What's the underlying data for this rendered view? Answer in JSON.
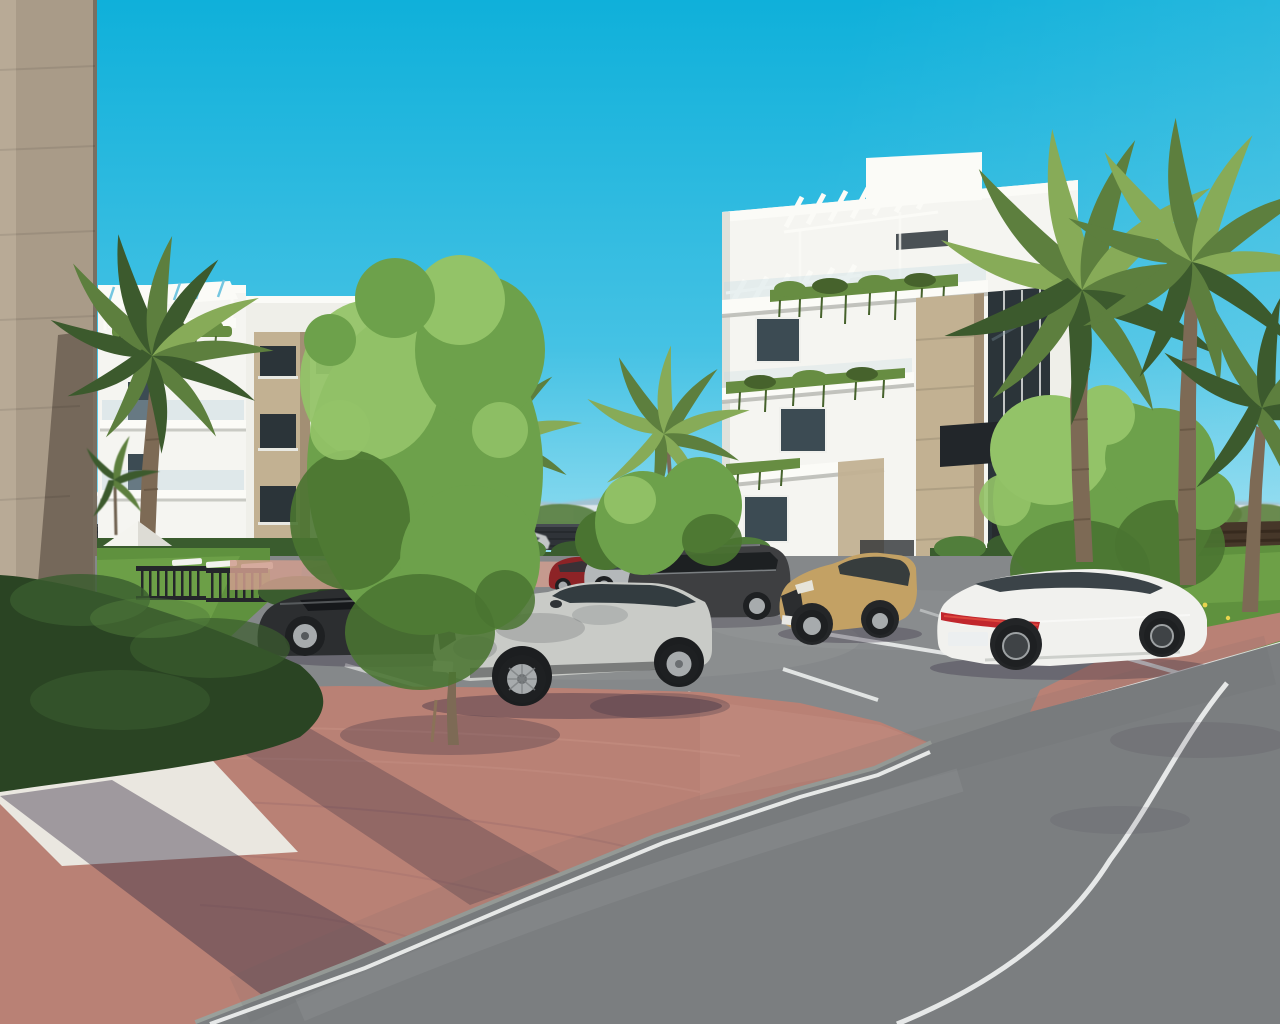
{
  "scene": {
    "title": "Exterior 3D render of a new-build apartment complex with parking",
    "description": "Photorealistic architectural rendering: two modern white apartment buildings with rooftop pergolas, planted balconies and beige stone cladding, surrounded by palm trees, deciduous trees, trimmed hedges and a lawn garden with a white parasol and sun loungers. Seven cars occupy an asphalt parking area beside a red clay-brick pedestrian walkway and a curving asphalt road under a clear cyan sky, with a marina town strip and mountains on the horizon.",
    "colors": {
      "sky_top": "#0fb0da",
      "sky_mid": "#45c2e4",
      "sky_horizon": "#9be0f2",
      "mountain": "#a9c0cd",
      "distant_building": "#dde6ea",
      "fence_dark": "#2f3338",
      "fence_brown": "#463729",
      "wall_face": "#a99b88",
      "wall_light": "#bcae9a",
      "wall_shade": "#6f6355",
      "building_white": "#f5f5f1",
      "building_tint": "#efefe9",
      "pergola_white": "#fbfbf7",
      "stone_beige": "#c2b192",
      "stone_dark": "#a28f74",
      "window_dark": "#2b3439",
      "window_glass": "#3c4b53",
      "plant_green": "#678d42",
      "plant_dark": "#46622c",
      "hedge_dark": "#2a4423",
      "hedge_mid": "#3a5c2e",
      "hedge_light": "#517e3b",
      "lawn": "#5f913e",
      "lawn_light": "#79ad4f",
      "tree_green": "#6da14b",
      "tree_light": "#93c368",
      "tree_dark": "#4a7431",
      "palm_green": "#5d7f3e",
      "palm_light": "#87ab58",
      "palm_dark": "#3c5a2d",
      "trunk": "#7d6a55",
      "trunk_dark": "#5f4f3d",
      "asphalt": "#85888a",
      "road": "#7b7e80",
      "curb": "#9aa09b",
      "line_white": "#eceeed",
      "brick": "#b98175",
      "brick_light": "#d09d8e",
      "brick_shadow": "#8a6168",
      "gravel": "#eae7e0",
      "shadow": "#372e42",
      "umbrella": "#f4f4ef",
      "gate_dark": "#24262a",
      "car_silver": "#c9cbc7",
      "car_white": "#f1f1ee",
      "car_tan": "#c3a164",
      "car_red": "#8d2326",
      "car_darkgray": "#3e3f41",
      "car_black": "#2c2e30",
      "car_silver2": "#b4b8ba",
      "car_teal": "#5d8292",
      "car_distant": "#c3c6c7",
      "tire": "#1e2022",
      "rim": "#a7abad",
      "taillight": "#c1272d"
    },
    "objects": [
      {
        "id": "sky",
        "label": "clear cyan sky"
      },
      {
        "id": "mountain-range",
        "label": "distant blue mountain ridge"
      },
      {
        "id": "marina-strip",
        "label": "distant white marina town strip"
      },
      {
        "id": "perimeter-fence",
        "label": "dark slatted perimeter fence"
      },
      {
        "id": "boundary-wall",
        "label": "beige concrete wall in left foreground"
      },
      {
        "id": "left-apartment-building",
        "label": "white apartment block with roof pergola and stone column"
      },
      {
        "id": "right-apartment-building",
        "label": "white apartment block with pergolas, planted balconies and stone cladding"
      },
      {
        "id": "clubhouse",
        "label": "distant glazed clubhouse terrace"
      },
      {
        "id": "garden",
        "label": "lawn garden with parasol, sun loungers and metal gate"
      },
      {
        "id": "hedges",
        "label": "trimmed box hedges"
      },
      {
        "id": "palm-trees",
        "label": "fan and feather palm trees"
      },
      {
        "id": "deciduous-trees",
        "label": "bright green deciduous trees"
      },
      {
        "id": "parking-lot",
        "label": "asphalt parking bays with white markings"
      },
      {
        "id": "vehicle-foreground-suv",
        "label": "silver Mercedes-style SUV in foreground bay"
      },
      {
        "id": "vehicle-dark-sedan",
        "label": "dark gray sedan"
      },
      {
        "id": "vehicle-teal-compact",
        "label": "teal compact car"
      },
      {
        "id": "vehicle-red-suv",
        "label": "dark red SUV"
      },
      {
        "id": "vehicle-silver-suv",
        "label": "silver SUV"
      },
      {
        "id": "vehicle-dark-suv",
        "label": "dark gray large SUV"
      },
      {
        "id": "vehicle-tan-crossover",
        "label": "tan compact crossover"
      },
      {
        "id": "vehicle-white-sedan",
        "label": "white luxury fastback sedan with red light bar"
      },
      {
        "id": "vehicle-distant-car",
        "label": "silver car on background road"
      },
      {
        "id": "brick-walkway",
        "label": "red clay brick pedestrian walkway"
      },
      {
        "id": "gravel-bed",
        "label": "white decorative gravel bed"
      },
      {
        "id": "road",
        "label": "curving asphalt road with white edge lines"
      },
      {
        "id": "tree-shadows",
        "label": "tree shadows cast on paving"
      }
    ]
  }
}
